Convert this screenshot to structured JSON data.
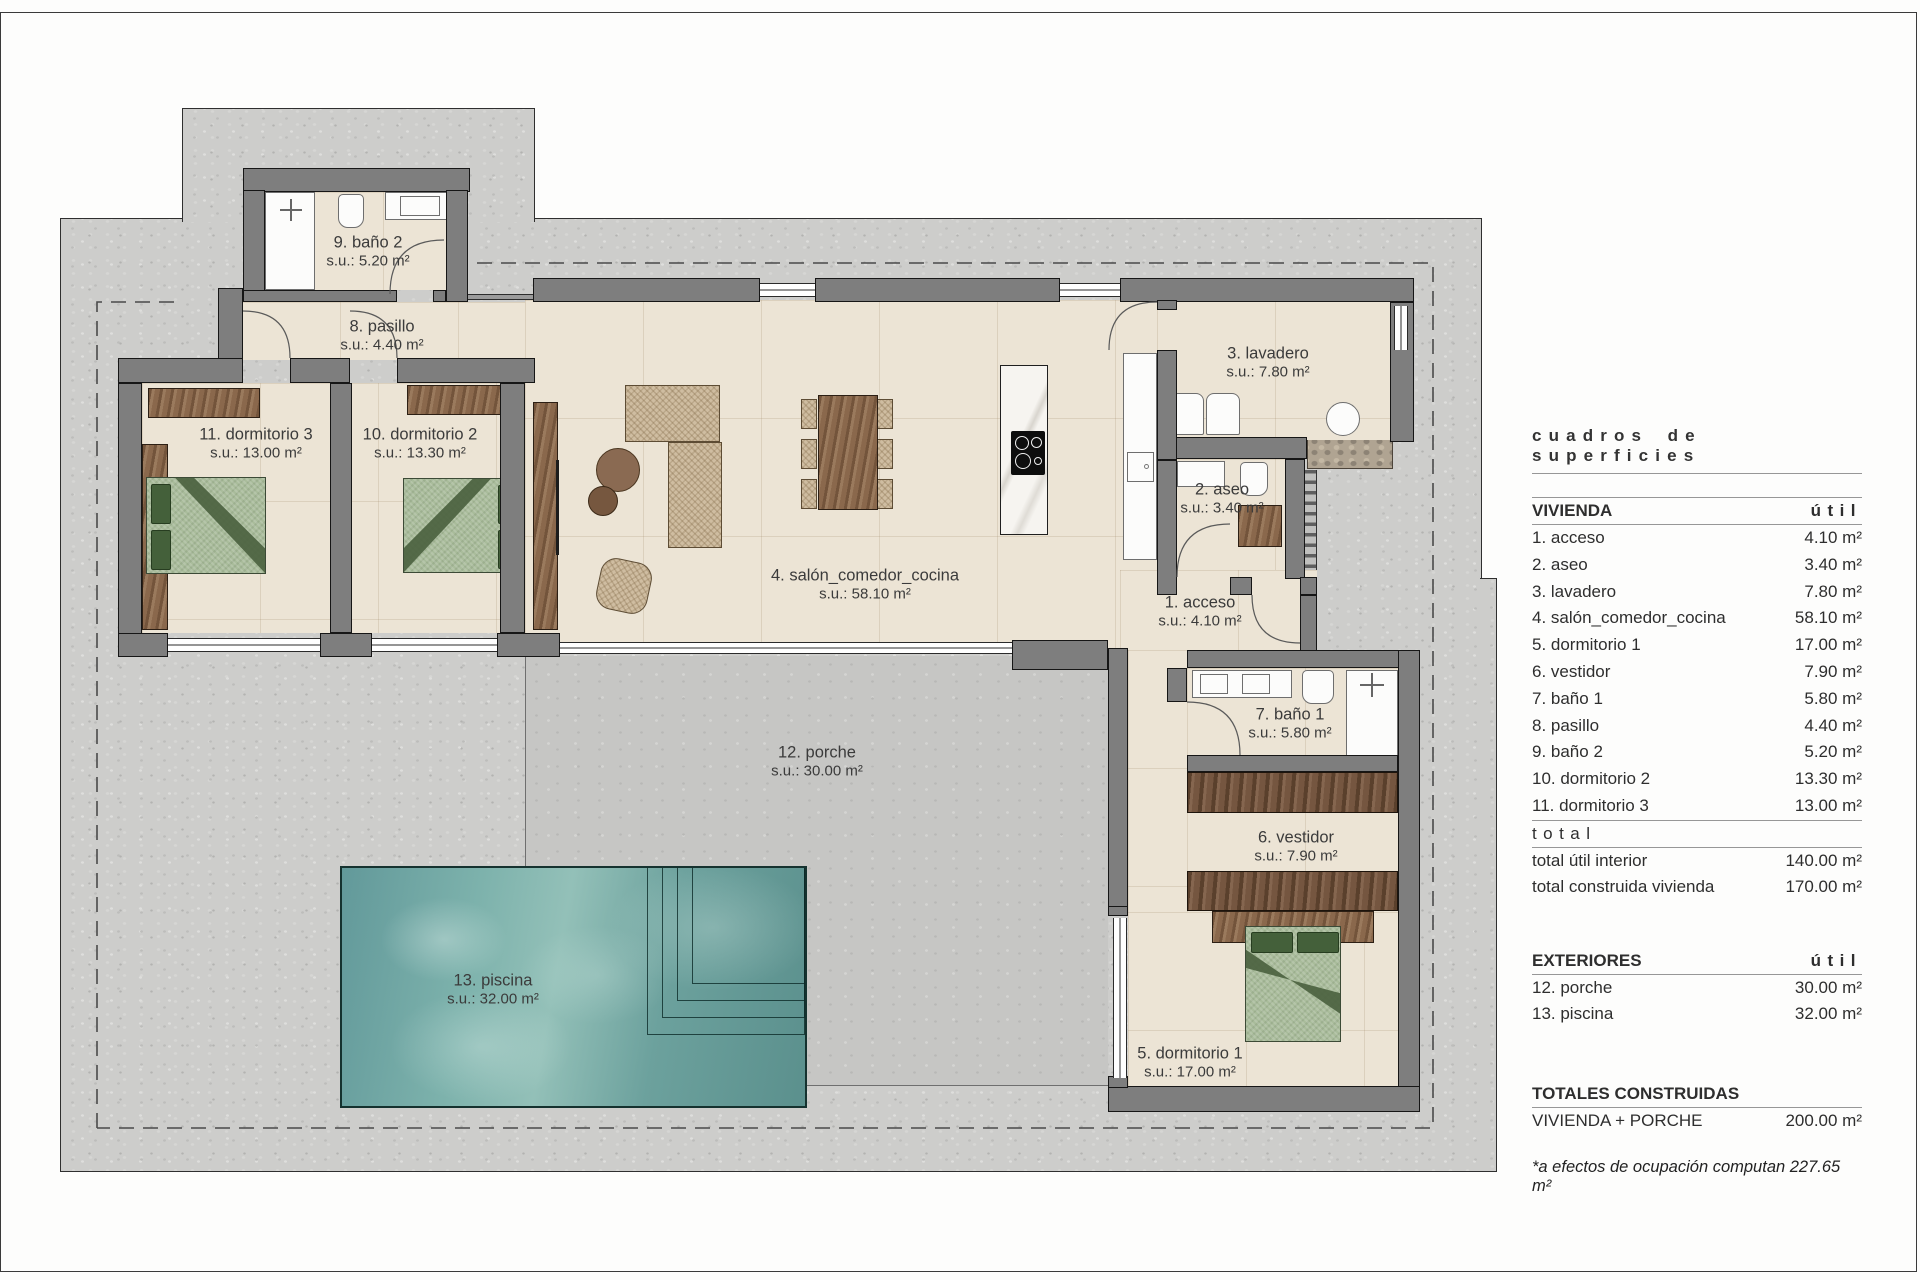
{
  "plan": {
    "rooms": [
      {
        "name": "1. acceso",
        "area": "s.u.: 4.10 m²"
      },
      {
        "name": "2. aseo",
        "area": "s.u.: 3.40 m²"
      },
      {
        "name": "3. lavadero",
        "area": "s.u.: 7.80 m²"
      },
      {
        "name": "4. salón_comedor_cocina",
        "area": "s.u.: 58.10 m²"
      },
      {
        "name": "5. dormitorio 1",
        "area": "s.u.: 17.00 m²"
      },
      {
        "name": "6. vestidor",
        "area": "s.u.: 7.90 m²"
      },
      {
        "name": "7. baño 1",
        "area": "s.u.: 5.80 m²"
      },
      {
        "name": "8. pasillo",
        "area": "s.u.: 4.40 m²"
      },
      {
        "name": "9. baño 2",
        "area": "s.u.: 5.20 m²"
      },
      {
        "name": "10. dormitorio 2",
        "area": "s.u.: 13.30 m²"
      },
      {
        "name": "11. dormitorio 3",
        "area": "s.u.: 13.00 m²"
      },
      {
        "name": "12. porche",
        "area": "s.u.: 30.00 m²"
      },
      {
        "name": "13. piscina",
        "area": "s.u.: 32.00 m²"
      }
    ]
  },
  "legend": {
    "title": "cuadros de superficies",
    "vivienda": {
      "header": "VIVIENDA",
      "unit_col": "útil",
      "rows": [
        {
          "label": "1. acceso",
          "value": "4.10 m²"
        },
        {
          "label": "2. aseo",
          "value": "3.40 m²"
        },
        {
          "label": "3. lavadero",
          "value": "7.80 m²"
        },
        {
          "label": "4. salón_comedor_cocina",
          "value": "58.10 m²"
        },
        {
          "label": "5. dormitorio 1",
          "value": "17.00 m²"
        },
        {
          "label": "6. vestidor",
          "value": "7.90 m²"
        },
        {
          "label": "7. baño 1",
          "value": "5.80 m²"
        },
        {
          "label": "8. pasillo",
          "value": "4.40 m²"
        },
        {
          "label": "9. baño 2",
          "value": "5.20 m²"
        },
        {
          "label": "10. dormitorio 2",
          "value": "13.30 m²"
        },
        {
          "label": "11. dormitorio 3",
          "value": "13.00 m²"
        }
      ],
      "total_header": "total",
      "totals": [
        {
          "label": "total útil interior",
          "value": "140.00 m²"
        },
        {
          "label": "total construida vivienda",
          "value": "170.00 m²"
        }
      ]
    },
    "exteriores": {
      "header": "EXTERIORES",
      "unit_col": "útil",
      "rows": [
        {
          "label": "12. porche",
          "value": "30.00 m²"
        },
        {
          "label": "13. piscina",
          "value": "32.00 m²"
        }
      ]
    },
    "totales": {
      "header": "TOTALES CONSTRUIDAS",
      "rows": [
        {
          "label": "VIVIENDA + PORCHE",
          "value": "200.00 m²"
        }
      ]
    },
    "footnote": "*a efectos de ocupación computan 227.65 m²"
  },
  "colors": {
    "wall": "#7e7e7e",
    "floor": "#ece4d5",
    "plot": "#cdcdcb",
    "porch": "#c6c6c4",
    "pool": "#6aa19e",
    "wood": "#8a684c",
    "bed_green": "#a9bc9b",
    "text": "#3b3b3b"
  }
}
